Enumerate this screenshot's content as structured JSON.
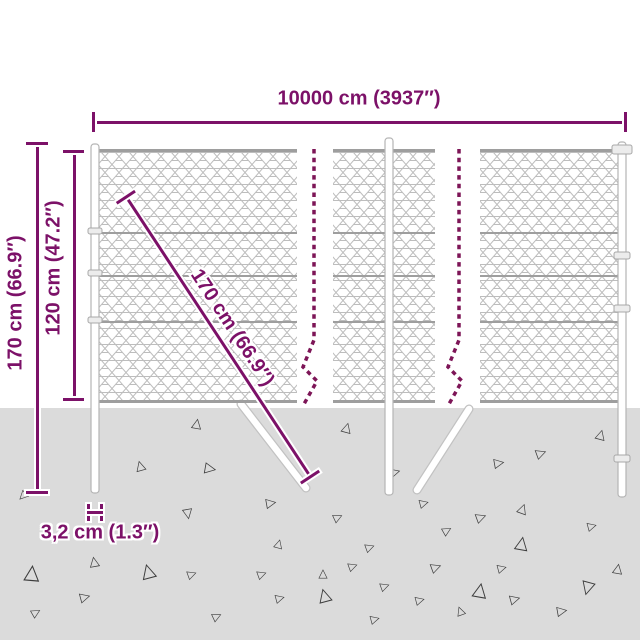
{
  "title": "Chain-link fence dimension diagram",
  "dimensions": {
    "width_label": "10000 cm (3937″)",
    "total_height_label": "170 cm (66.9″)",
    "above_ground_label": "120 cm (47.2″)",
    "diagonal_label": "170 cm (66.9″)",
    "post_width_label": "3,2 cm (1.3″)"
  },
  "colors": {
    "dimension_magenta": "#7c1168",
    "dash_maroon": "#7d1557",
    "ground_gray": "#dbdbdb",
    "mesh_wire_gray": "#bdbdbd",
    "tension_wire_gray": "#9e9e9e",
    "post_outline_gray": "#b5b5b5",
    "triangle_gray": "#3c3c3c"
  },
  "ground": {
    "triangles": [
      [
        197,
        423,
        9,
        10
      ],
      [
        140,
        465,
        9,
        -15
      ],
      [
        211,
        469,
        10,
        100
      ],
      [
        188,
        515,
        9,
        170
      ],
      [
        272,
        503,
        9,
        80
      ],
      [
        279,
        543,
        8,
        15
      ],
      [
        22,
        497,
        8,
        225
      ],
      [
        347,
        427,
        9,
        15
      ],
      [
        396,
        472,
        9,
        75
      ],
      [
        500,
        463,
        9,
        80
      ],
      [
        542,
        453,
        9,
        70
      ],
      [
        601,
        434,
        9,
        15
      ],
      [
        425,
        503,
        8,
        75
      ],
      [
        523,
        508,
        9,
        20
      ],
      [
        339,
        517,
        8,
        65
      ],
      [
        482,
        517,
        9,
        70
      ],
      [
        448,
        530,
        8,
        60
      ],
      [
        522,
        542,
        12,
        10
      ],
      [
        371,
        547,
        8,
        70
      ],
      [
        593,
        526,
        8,
        75
      ],
      [
        32,
        572,
        14,
        5
      ],
      [
        94,
        561,
        9,
        -10
      ],
      [
        148,
        571,
        13,
        -15
      ],
      [
        193,
        574,
        8,
        70
      ],
      [
        86,
        597,
        9,
        75
      ],
      [
        37,
        612,
        8,
        60
      ],
      [
        218,
        616,
        8,
        65
      ],
      [
        263,
        574,
        8,
        70
      ],
      [
        281,
        598,
        8,
        75
      ],
      [
        324,
        594,
        12,
        -15
      ],
      [
        354,
        566,
        8,
        70
      ],
      [
        376,
        619,
        8,
        75
      ],
      [
        386,
        586,
        8,
        70
      ],
      [
        421,
        600,
        8,
        75
      ],
      [
        460,
        610,
        8,
        -20
      ],
      [
        480,
        590,
        13,
        10
      ],
      [
        503,
        568,
        8,
        75
      ],
      [
        587,
        590,
        12,
        195
      ],
      [
        618,
        568,
        9,
        10
      ],
      [
        563,
        611,
        9,
        80
      ],
      [
        516,
        599,
        9,
        75
      ],
      [
        437,
        567,
        9,
        70
      ],
      [
        323,
        573,
        8,
        0
      ]
    ]
  }
}
